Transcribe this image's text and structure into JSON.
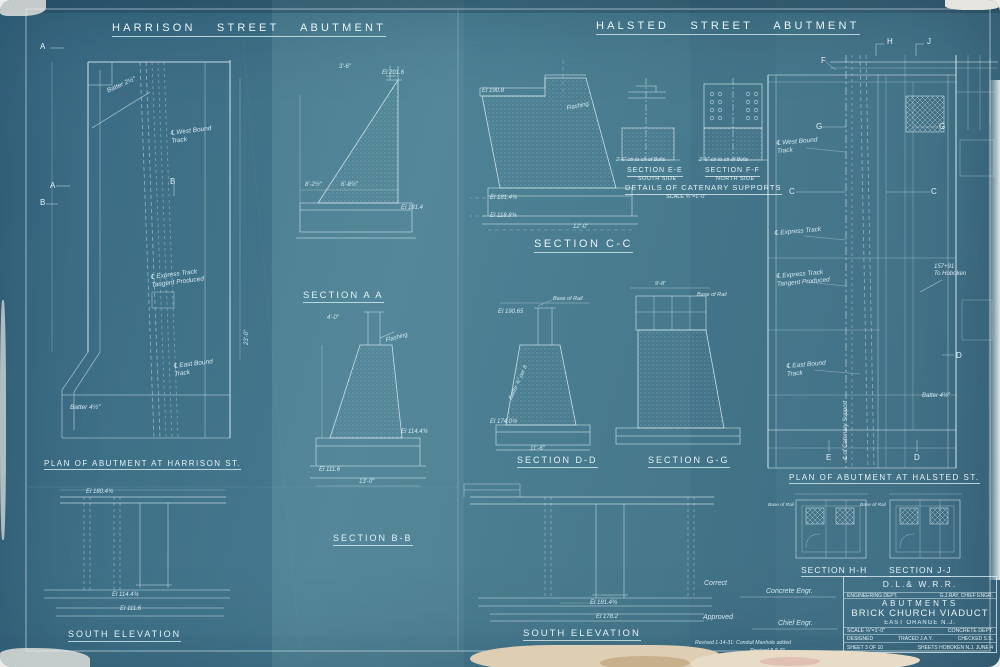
{
  "colors": {
    "sheet_blue": "#46798e",
    "line_white": "#dceef3",
    "torn_paper": "#e2d3b6",
    "backing": "#edecea"
  },
  "titles": {
    "harrison": "HARRISON STREET ABUTMENT",
    "halsted": "HALSTED STREET ABUTMENT"
  },
  "captions": {
    "plan_harrison": "PLAN OF ABUTMENT AT HARRISON ST.",
    "south_elevation_left": "SOUTH ELEVATION",
    "section_aa": "SECTION A A",
    "section_bb": "SECTION B-B",
    "section_cc": "SECTION C-C",
    "section_dd": "SECTION D-D",
    "section_gg": "SECTION G-G",
    "section_ee": "SECTION E-E",
    "section_ee_side": "SOUTH SIDE",
    "section_ff": "SECTION F-F",
    "section_ff_side": "NORTH SIDE",
    "catenary": "DETAILS OF CATENARY SUPPORTS",
    "catenary_scale": "SCALE ¾″=1'-0″",
    "plan_halsted": "PLAN OF ABUTMENT AT HALSTED ST.",
    "section_hh": "SECTION H-H",
    "section_jj": "SECTION J-J",
    "south_elevation_center": "SOUTH ELEVATION"
  },
  "ann": {
    "batter_2h": "Batter 2½″",
    "wb_track": "℄ West Bound\nTrack",
    "express_tangent": "℄ Express Track\nTangent Produced",
    "eb_track": "℄ East Bound\nTrack",
    "batter_4h": "Batter 4½″",
    "dim_23": "23'-0″",
    "el_180": "El 180.4¾",
    "el_114": "El 114.4¾",
    "el_111": "El 111.6",
    "dim_36": "3'-6″",
    "el_201": "El 201.6",
    "dim_82": "8'-2½″",
    "dim_68": "6'-8½″",
    "el_181": "El 181.4",
    "flashing": "Flashing",
    "dim_40": "4'-0″",
    "dim_13": "13'-0″",
    "el_190": "El 190.8",
    "el_1814": "El 181.4¾",
    "el_118": "El 118.8¾",
    "dim_12": "12'-0″",
    "bolts": "2'-6″ ctr to ctr of Bolts",
    "el_19065": "El 190.65",
    "base_rail": "Base of Rail",
    "batter_ft": "Batter ¾″ per ft",
    "el_174": "El 174.0¾",
    "dim_116": "11'-6″",
    "dim_98": "9'-8″",
    "express": "℄ Express Track",
    "catenary_cl": "℄ of Catenary Support",
    "station": "157+91\nTo Hoboken",
    "el_1782": "El 178.2"
  },
  "mk": {
    "a": "A",
    "b": "B",
    "c": "C",
    "d": "D",
    "e": "E",
    "f": "F",
    "g": "G",
    "h": "H",
    "j": "J"
  },
  "tb": {
    "railroad": "D.L.& W.R.R.",
    "dept": "ENGINEERING DEPT.",
    "chief": "G.J.RAY, CHIEF ENGR.",
    "subject": "ABUTMENTS",
    "project": "BRICK CHURCH VIADUCT",
    "location": "EAST ORANGE N.J.",
    "scale": "SCALE ⅛″=1'-0″",
    "dept2": "CONCRETE DEPT.",
    "designed": "DESIGNED",
    "traced": "TRACED J.A.Y.",
    "checked": "CHECKED S.S.",
    "sheet": "SHEET 3 OF 10",
    "drawn": "SHEETS  HOBOKEN N.J. JUNE 4"
  },
  "sign": {
    "correct": "Correct",
    "concrete_engr": "Concrete Engr.",
    "approved": "Approved",
    "chief_engr": "Chief Engr.",
    "rev1": "Revised 1-14-31: Conduit Manhole added",
    "rev2": "Revised 8-8-31"
  }
}
